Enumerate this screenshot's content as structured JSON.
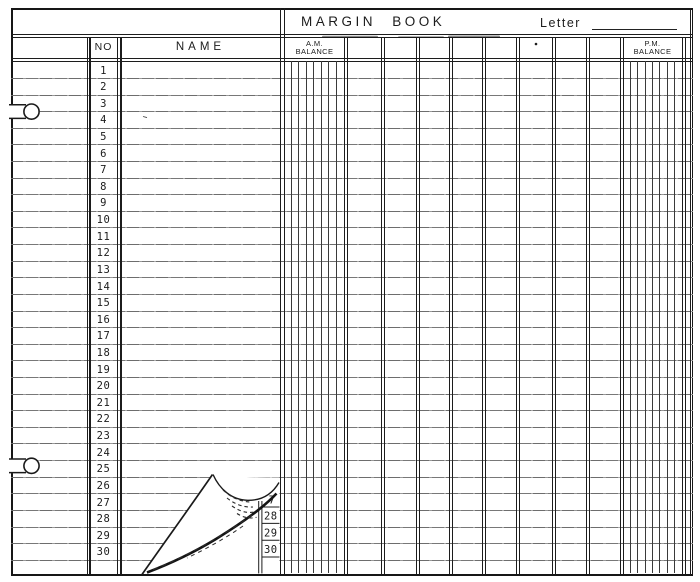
{
  "form": {
    "title": "MARGIN BOOK",
    "letter_label": "Letter",
    "columns": {
      "no": "NO",
      "name": "NAME",
      "am_line1": "A.M.",
      "am_line2": "BALANCE",
      "pm_line1": "P.M.",
      "pm_line2": "BALANCE"
    },
    "row_numbers": [
      "1",
      "2",
      "3",
      "4",
      "5",
      "6",
      "7",
      "8",
      "9",
      "10",
      "11",
      "12",
      "13",
      "14",
      "15",
      "16",
      "17",
      "18",
      "19",
      "20",
      "21",
      "22",
      "23",
      "24",
      "25",
      "26",
      "27",
      "28",
      "29",
      "30"
    ],
    "page_curl": {
      "revealed_numbers": [
        "7",
        "28",
        "29",
        "30"
      ]
    },
    "colors": {
      "ink": "#1c1c1c",
      "rule": "#767676",
      "paper": "#ffffff"
    }
  }
}
